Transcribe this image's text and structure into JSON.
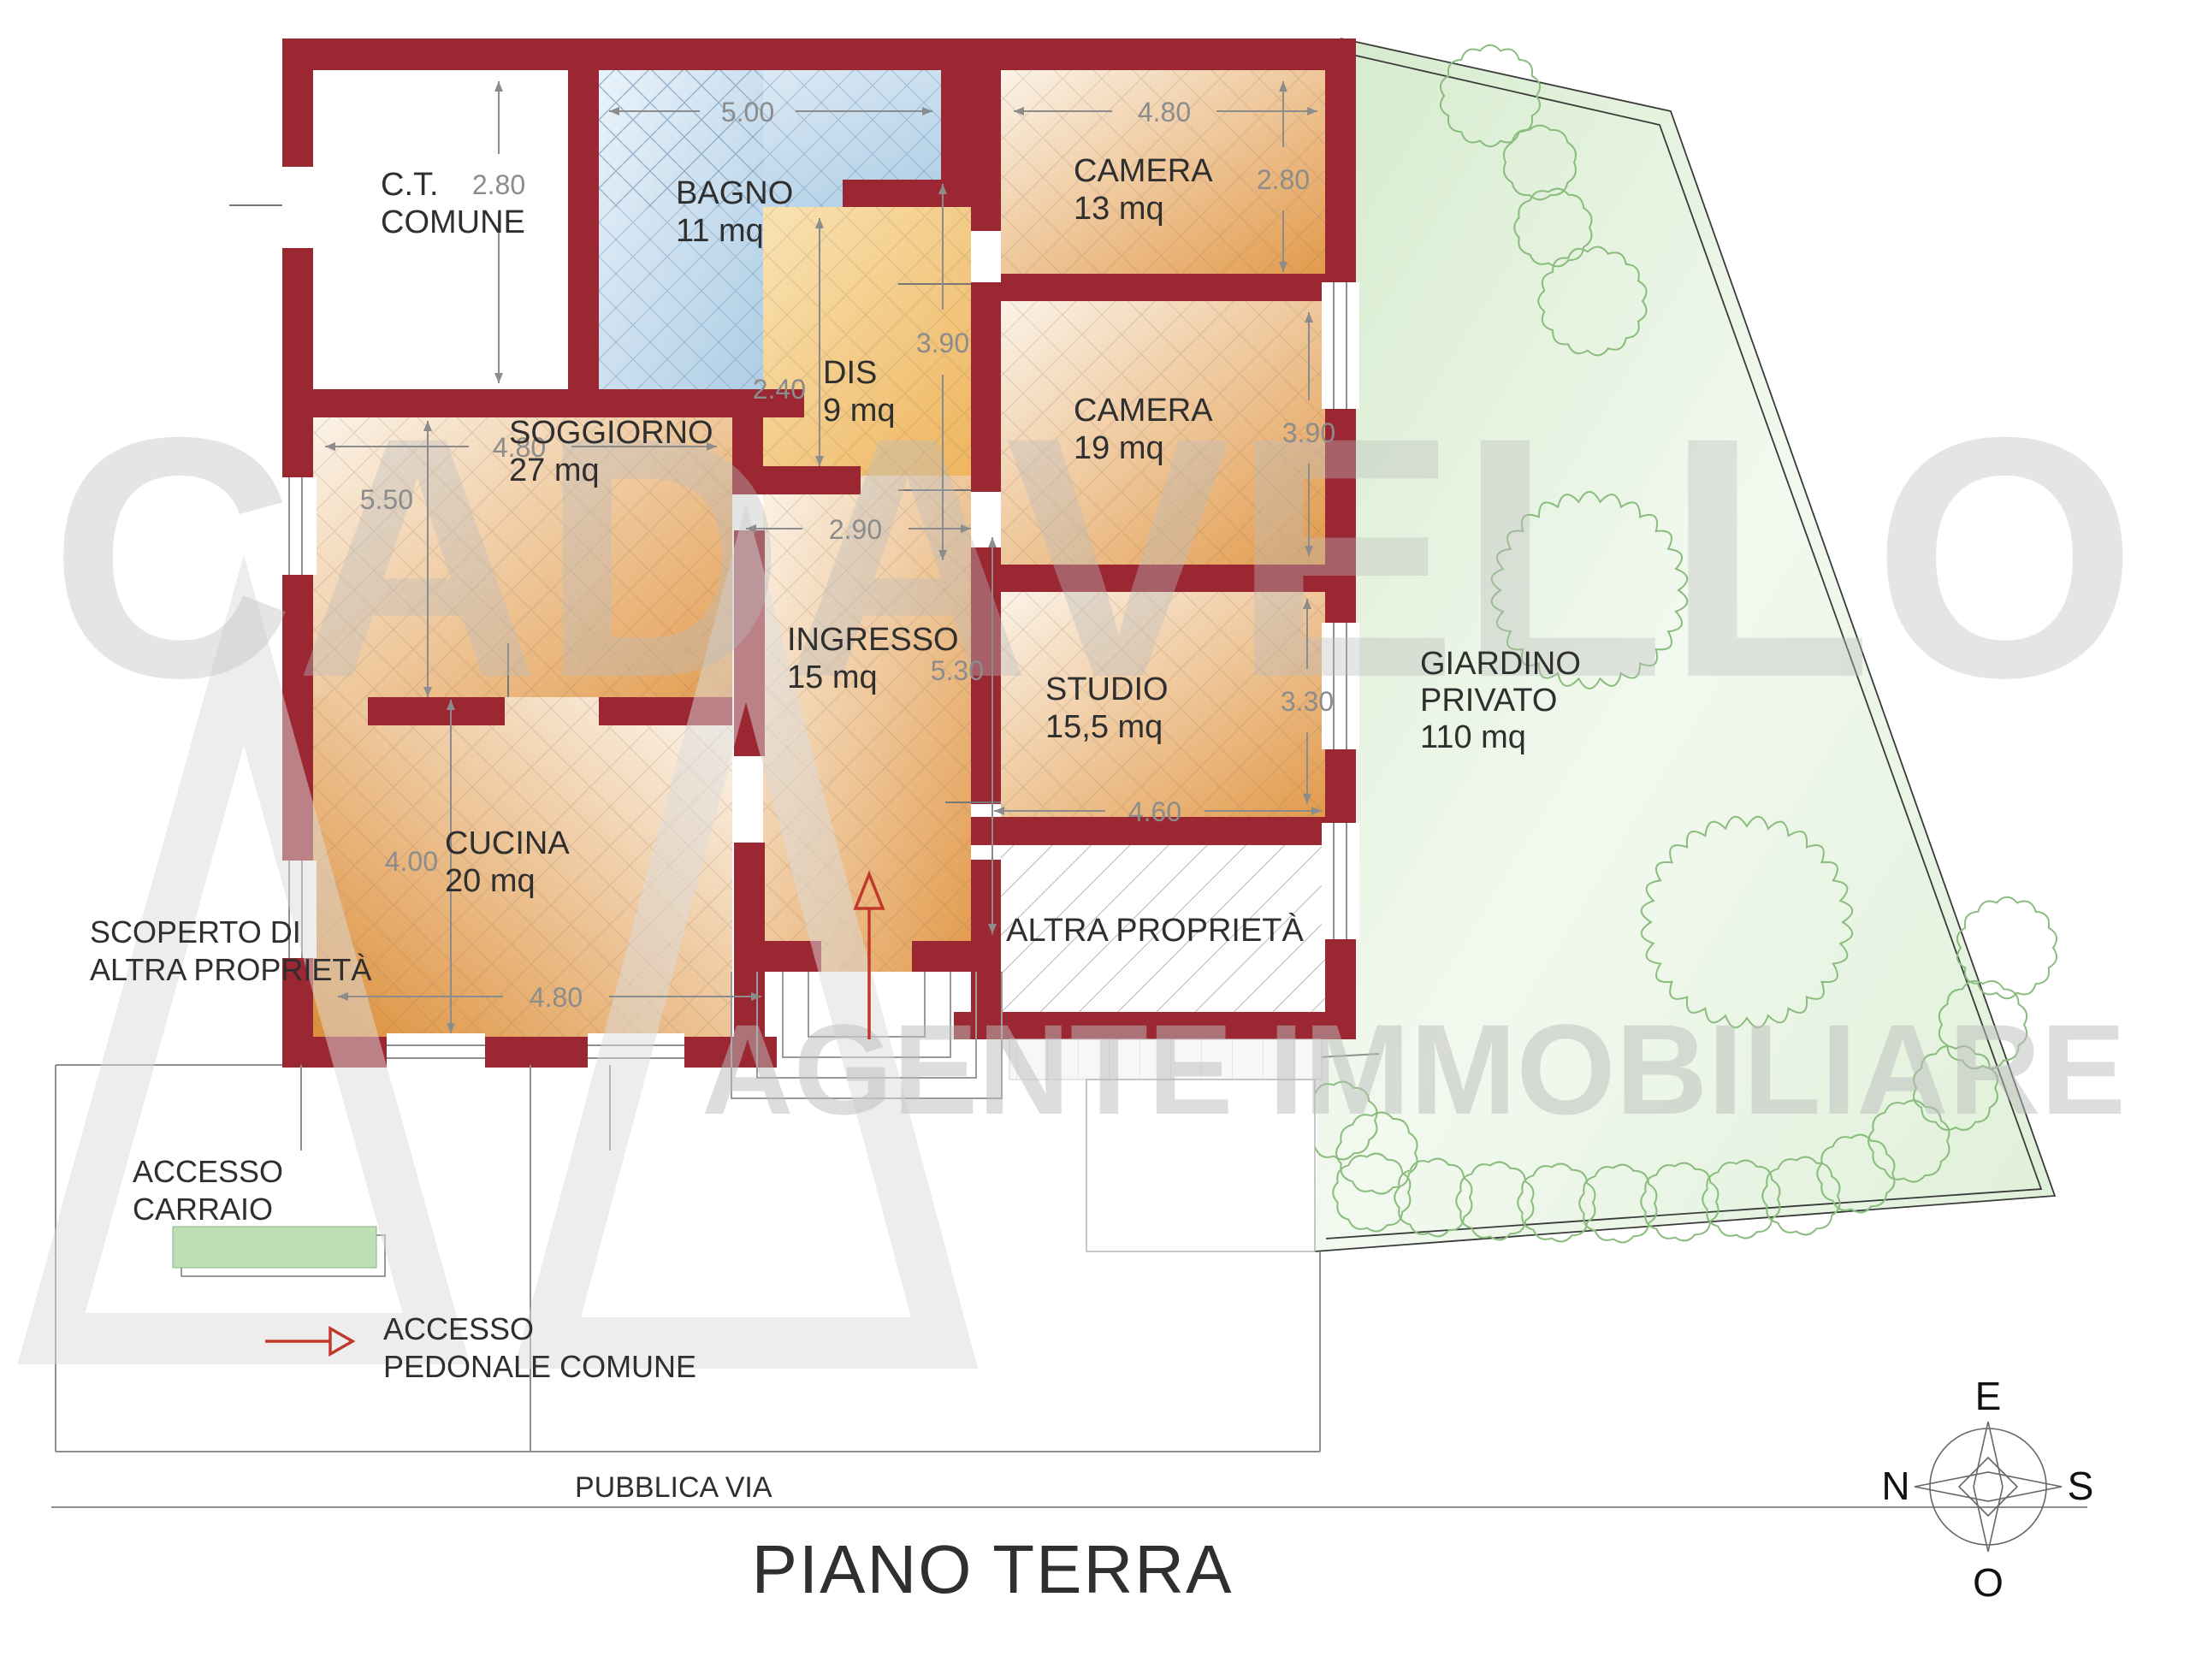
{
  "title": "PIANO TERRA",
  "watermark": {
    "name": "CADAVELLO",
    "tagline": "AGENTE IMMOBILIARE"
  },
  "rooms": {
    "ct": {
      "label": "C.T.",
      "label2": "COMUNE"
    },
    "bagno": {
      "label": "BAGNO",
      "area": "11 mq"
    },
    "camera13": {
      "label": "CAMERA",
      "area": "13 mq"
    },
    "soggiorno": {
      "label": "SOGGIORNO",
      "area": "27 mq"
    },
    "dis": {
      "label": "DIS",
      "area": "9  mq"
    },
    "camera19": {
      "label": "CAMERA",
      "area": "19 mq"
    },
    "ingresso": {
      "label": "INGRESSO",
      "area": "15  mq"
    },
    "studio": {
      "label": "STUDIO",
      "area": "15,5  mq"
    },
    "cucina": {
      "label": "CUCINA",
      "area": "20 mq"
    },
    "altra": {
      "label": "ALTRA PROPRIETÀ"
    },
    "giardino": {
      "label": "GIARDINO",
      "label2": "PRIVATO",
      "area": "110 mq"
    }
  },
  "dimensions": {
    "bagno_w": "5.00",
    "bagno_h": "2.80",
    "camera13_w": "4.80",
    "camera13_h": "2.80",
    "soggiorno_w": "4.80",
    "soggiorno_h": "5.50",
    "dis_h": "2.40",
    "dis_w": "2.90",
    "corridoio_h": "3.90",
    "camera19_h": "3.90",
    "ingresso_h": "5.30",
    "studio_h": "3.30",
    "studio_w": "4.60",
    "cucina_h": "4.00",
    "cucina_w": "4.80"
  },
  "site": {
    "scoperto_line1": "SCOPERTO DI",
    "scoperto_line2": "ALTRA PROPRIETÀ",
    "carraio_line1": "ACCESSO",
    "carraio_line2": "CARRAIO",
    "pedonale_line1": "ACCESSO",
    "pedonale_line2": "PEDONALE COMUNE",
    "via": "PUBBLICA VIA"
  },
  "compass": {
    "top": "E",
    "left": "N",
    "right": "S",
    "bottom": "O"
  },
  "colors": {
    "wall": "#9a2732",
    "dimension": "#8c8c8c",
    "text": "#2f2f2f",
    "garden_tree": "#8abc7d",
    "arrow_red": "#c0392b",
    "bagno_blue": "#b6d2e8",
    "room_orange": "#e29a4b",
    "garden_green": "#d8ecd0"
  }
}
